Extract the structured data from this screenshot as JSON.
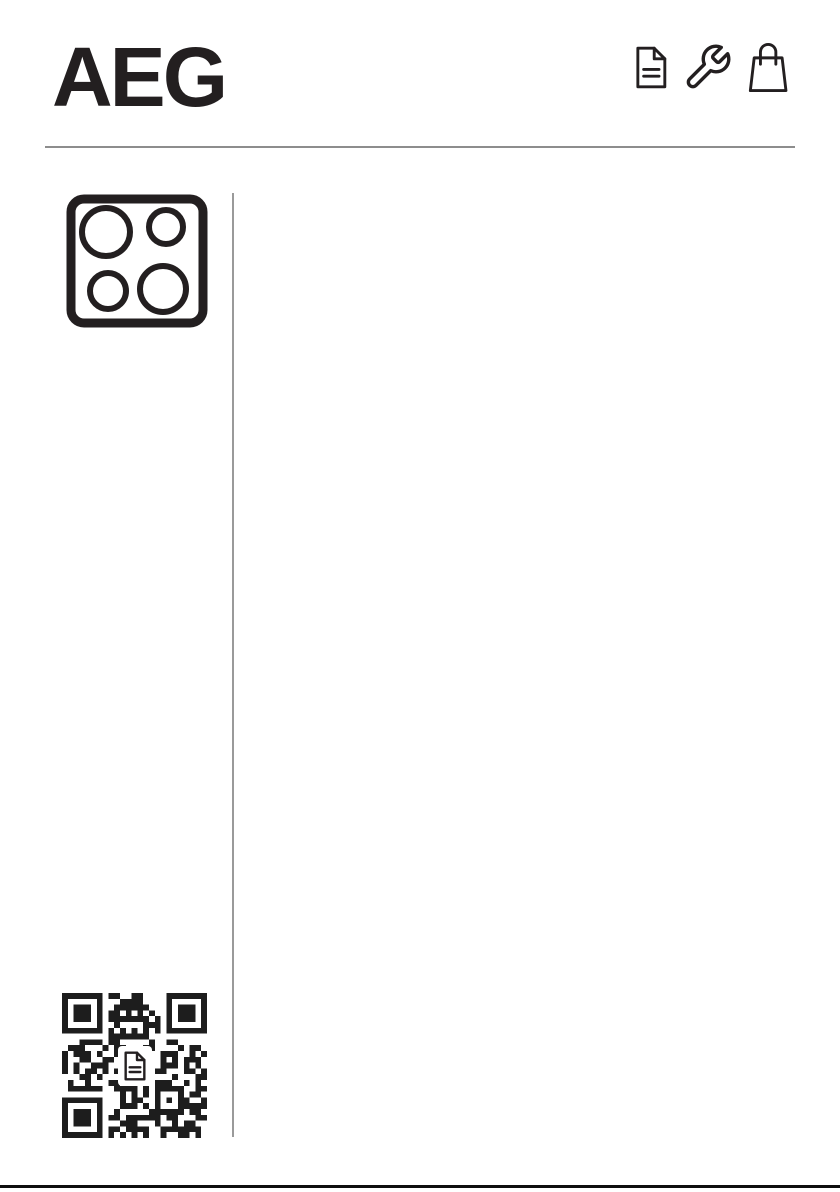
{
  "header": {
    "logo_text": "AEG",
    "icons": [
      {
        "name": "document-icon"
      },
      {
        "name": "wrench-icon"
      },
      {
        "name": "shopping-bag-icon"
      }
    ]
  },
  "left_column": {
    "hob_icon": "cooktop-4-zones-icon",
    "qr_code": {
      "center_icon": "document-icon"
    }
  },
  "colors": {
    "ink": "#231f20",
    "rule_gray": "#8d8d8d",
    "divider_gray": "#9a9a9a",
    "background": "#ffffff",
    "footer_bar": "#0f0f0f"
  }
}
